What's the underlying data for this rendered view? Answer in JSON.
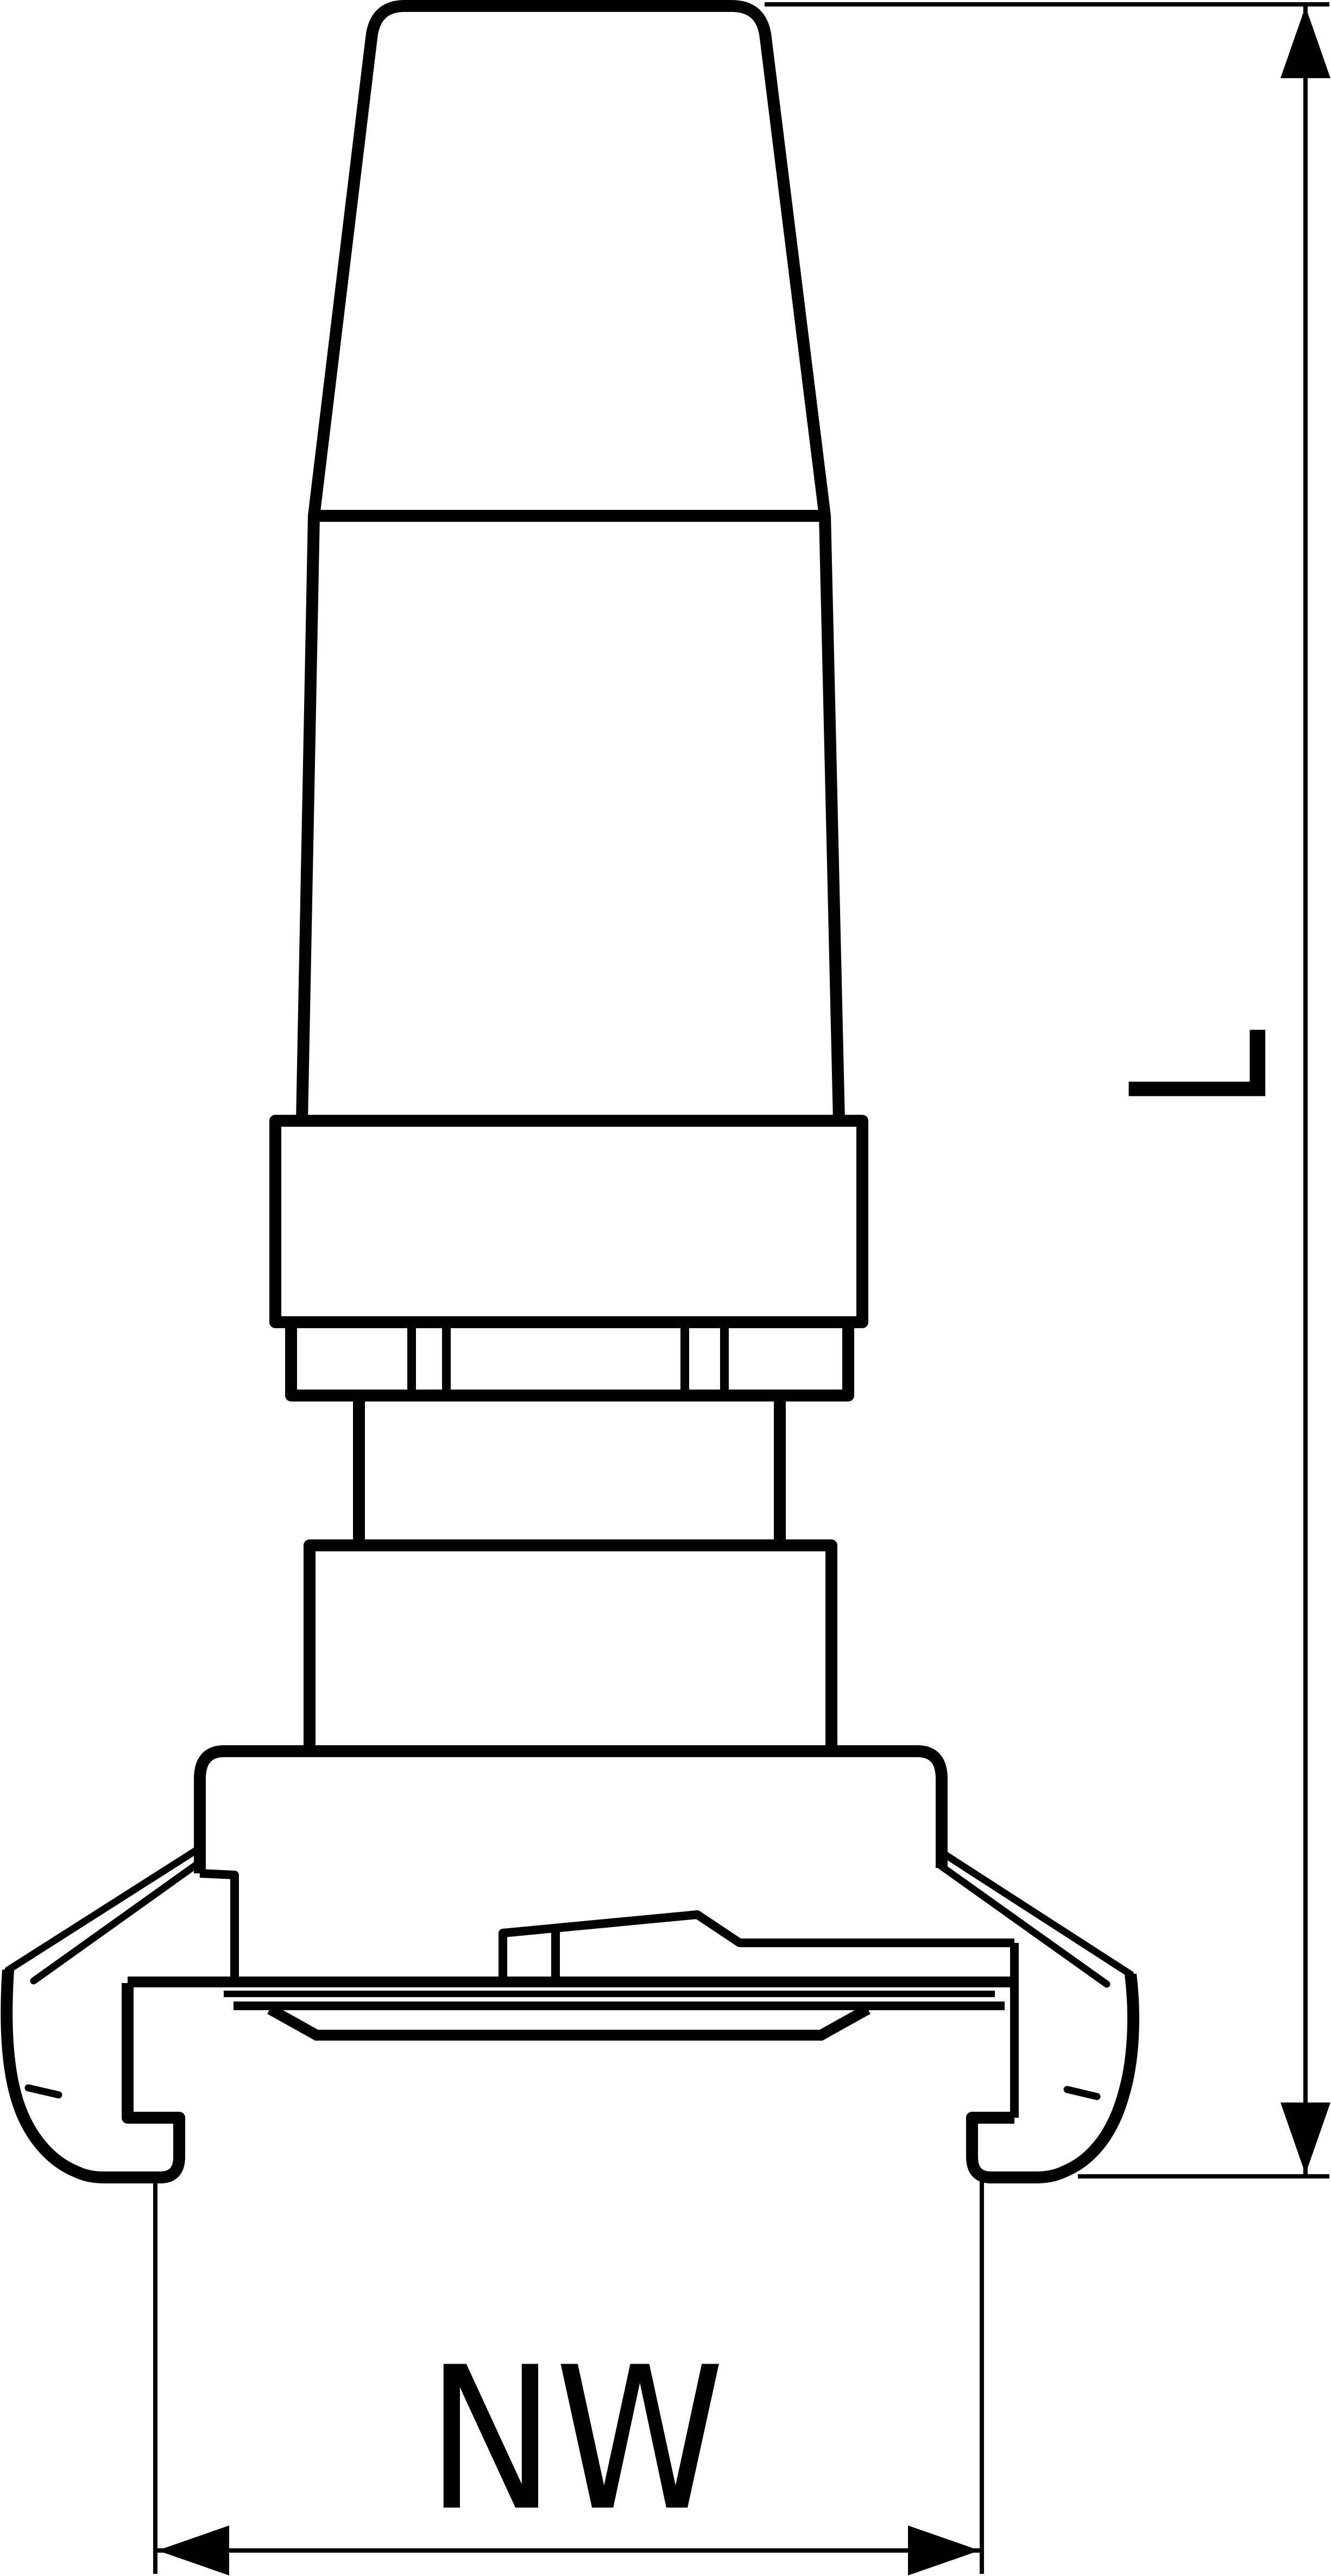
{
  "drawing": {
    "background_color": "#ffffff",
    "line_color": "#000000",
    "labels": {
      "length": "L",
      "nominal_width": "NW"
    }
  }
}
